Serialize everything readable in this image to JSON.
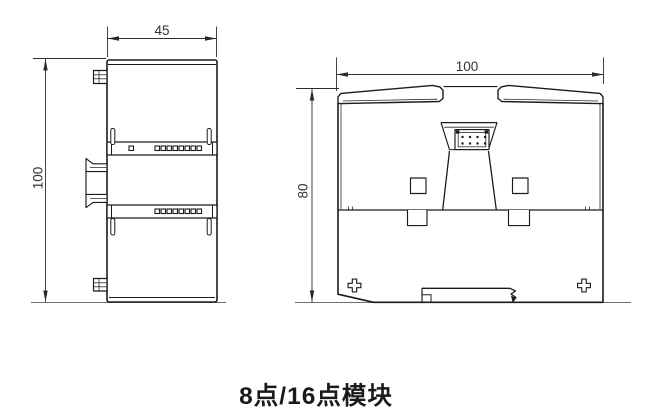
{
  "drawing": {
    "caption": "8点/16点模块",
    "side_view": {
      "width_dim": "45",
      "height_dim": "100"
    },
    "rear_view": {
      "width_dim": "100",
      "height_dim": "80"
    }
  },
  "colors": {
    "outline": "#1c1c1c",
    "dimension_line": "#2e2e2e",
    "dimension_text": "#333333",
    "ground_line": "#6e6e6e",
    "background": "#ffffff",
    "caption_text": "#1a1a1a"
  }
}
